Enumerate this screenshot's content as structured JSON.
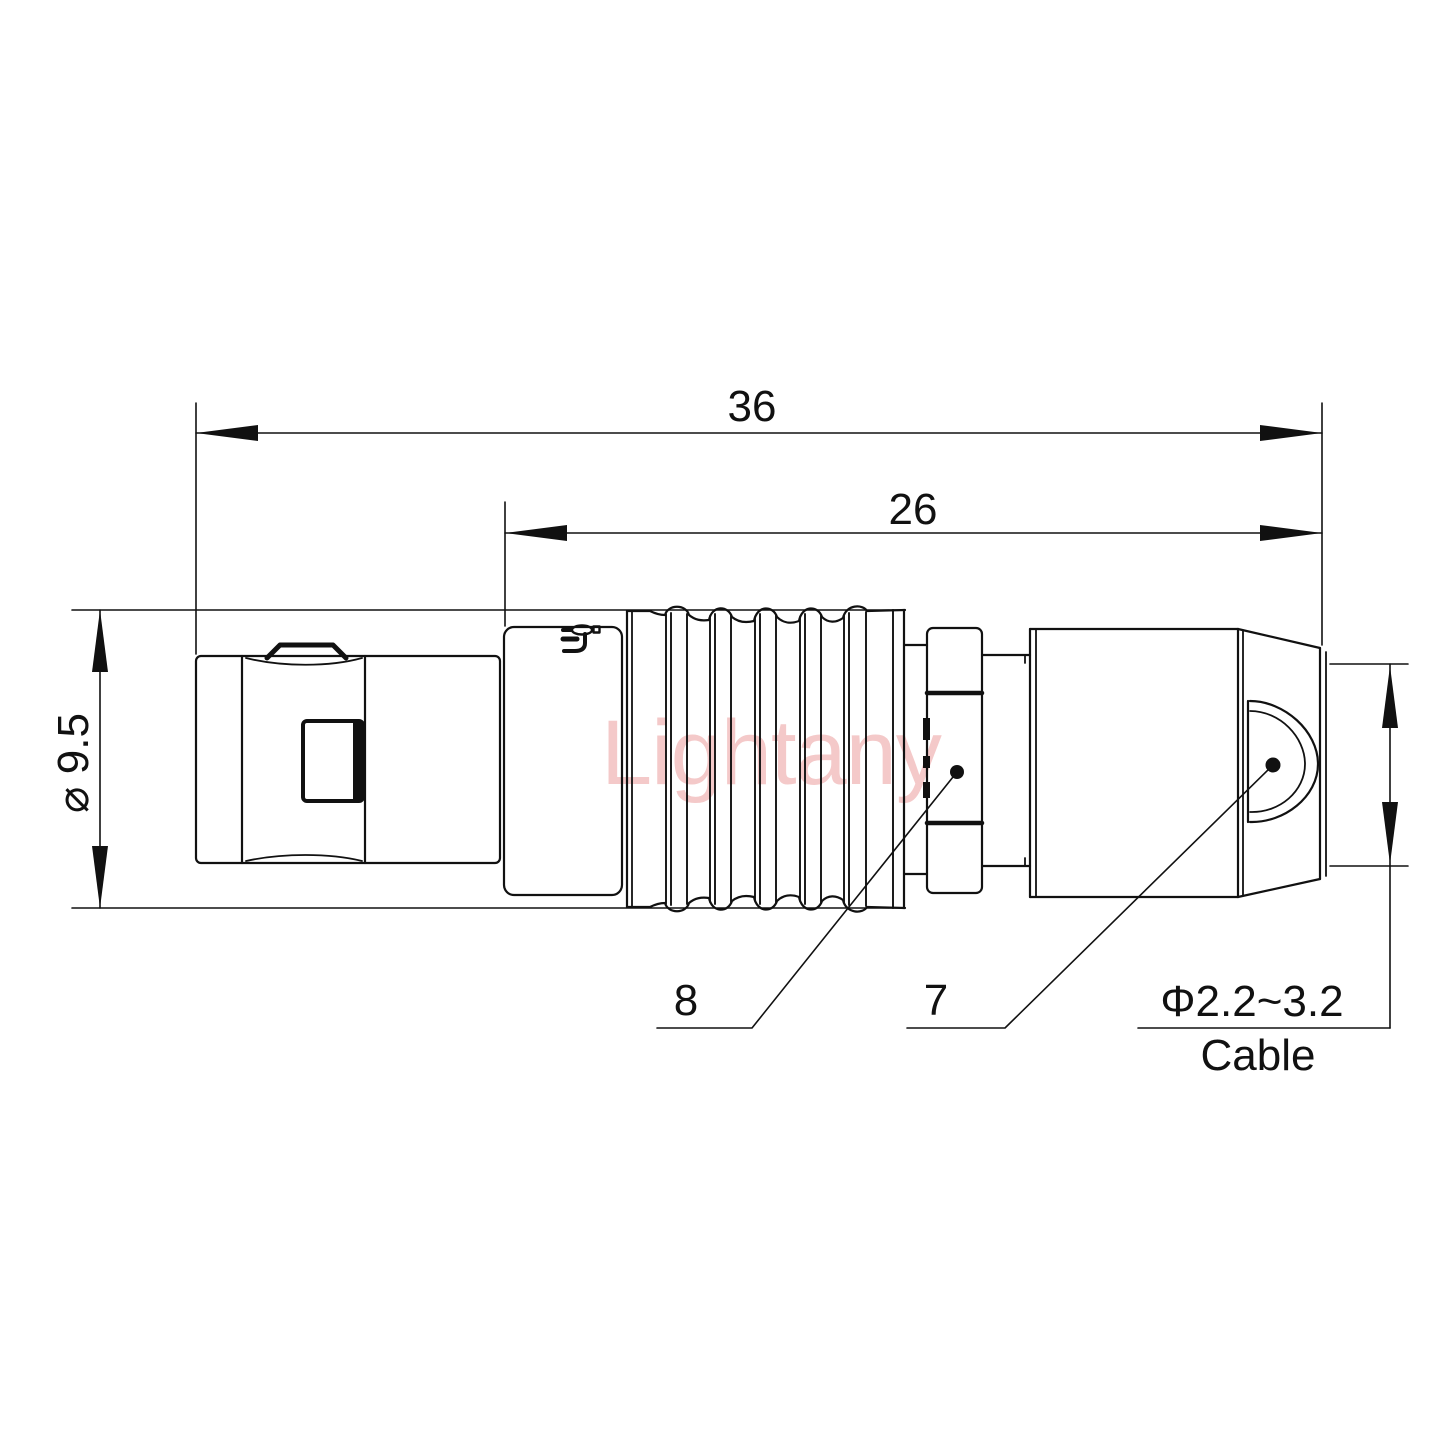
{
  "drawing": {
    "dimensions": {
      "overall_length": "36",
      "rear_section_length": "26",
      "body_diameter": "⌀ 9.5",
      "cable_spec": "Φ2.2~3.2",
      "cable_label": "Cable"
    },
    "part_callouts": {
      "clamp_ring": "8",
      "nut": "7"
    },
    "watermark": "Lightany"
  },
  "colors": {
    "line": "#111111",
    "watermark": "#f4c9c9",
    "background": "#ffffff"
  }
}
